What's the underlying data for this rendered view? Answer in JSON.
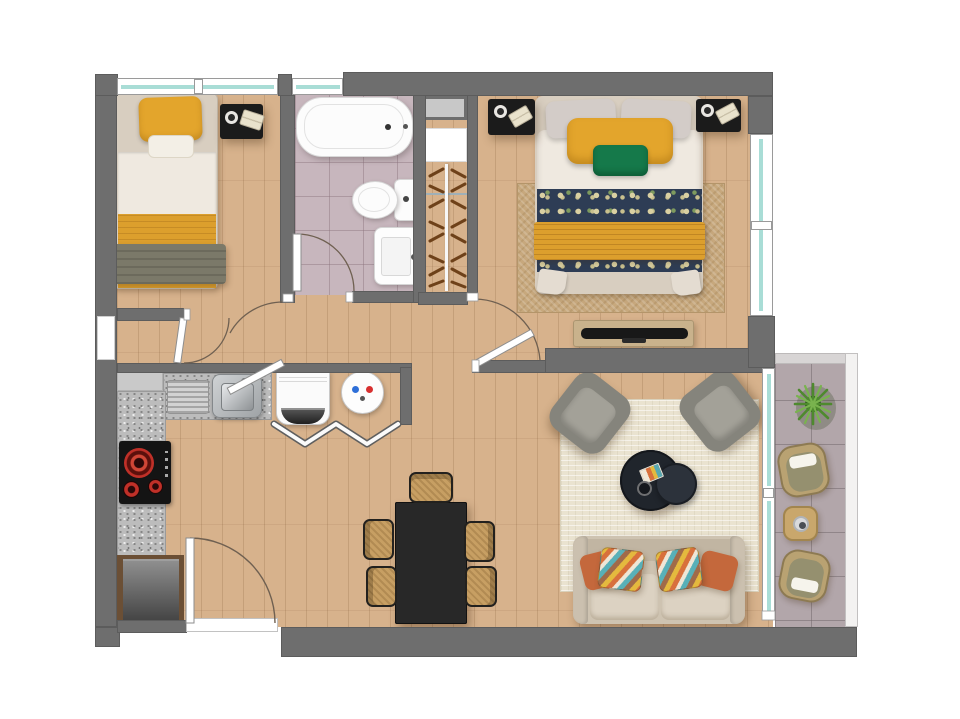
{
  "plan": {
    "type": "apartment-floor-plan-top-view",
    "rooms": [
      {
        "name": "small-bedroom",
        "furniture": [
          "single-bed",
          "nightstand",
          "window"
        ]
      },
      {
        "name": "bathroom",
        "furniture": [
          "bathtub",
          "toilet",
          "sink-vanity",
          "window",
          "door"
        ]
      },
      {
        "name": "wardrobe-closet",
        "furniture": [
          "shaft",
          "shelf",
          "hanging-rail",
          "clothes-hangers"
        ]
      },
      {
        "name": "master-bedroom",
        "furniture": [
          "double-bed",
          "nightstand-left",
          "nightstand-right",
          "rug",
          "tv-console",
          "window",
          "door"
        ]
      },
      {
        "name": "kitchen",
        "furniture": [
          "l-shaped-granite-counter",
          "sink",
          "drainboard",
          "cooktop",
          "refrigerator",
          "washing-machine",
          "water-heater",
          "bifold-doors"
        ]
      },
      {
        "name": "dining-area",
        "furniture": [
          "dining-table",
          "chair-head",
          "chair-left-1",
          "chair-left-2",
          "chair-right-1",
          "chair-right-2"
        ]
      },
      {
        "name": "living-room",
        "furniture": [
          "sofa",
          "armchair-left",
          "armchair-right",
          "coffee-table-large",
          "coffee-table-small",
          "rug",
          "entry-door"
        ]
      },
      {
        "name": "balcony",
        "furniture": [
          "plant",
          "wicker-chair-top",
          "side-table",
          "wicker-chair-bottom",
          "glass-railing",
          "sliding-glass-door"
        ]
      }
    ]
  },
  "colors": {
    "wall": "#6e6e6e",
    "wood-floor": "#d7b28c",
    "bath-tile": "#c7b6bd",
    "balcony-tile": "#b2a6aa",
    "glass": "#a9ddd6",
    "granite": "#bcbcbc",
    "bed-frame": "#d8cec0",
    "duvet-white": "#efe9e0",
    "pillow-yellow": "#e3a52c",
    "pillow-green": "#15794a",
    "blanket-gray": "#7b7969",
    "floral-navy": "#2e3d55",
    "throw-yellow": "#dc9f2d",
    "rug-tan": "#c7a87d",
    "rug-cream": "#eae3d0",
    "sofa-beige": "#cec3b1",
    "cushion-beige": "#dcd2c2",
    "pillow-orange": "#c4683c",
    "armchair-gray": "#85847c",
    "armchair-cushion": "#a3a198",
    "table-black": "#282828",
    "wicker": "#c79f63",
    "console-wood": "#c9b28c",
    "tv-black": "#181818",
    "nightstand-black": "#1b1b1b",
    "fridge-gray": "#5c5c5c",
    "burner-red": "#cc3326",
    "boiler-blue": "#2e6fd8",
    "boiler-red": "#d83030",
    "plant-green": "#4e8a2e",
    "door-arc": "#6f6051"
  }
}
